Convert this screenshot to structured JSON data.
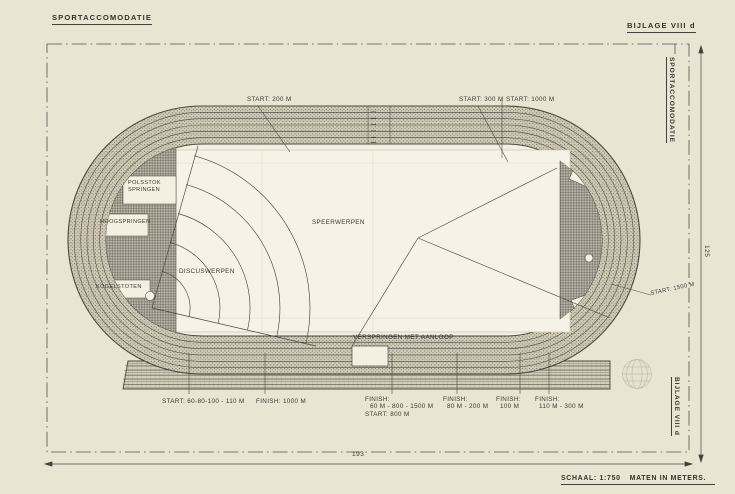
{
  "colors": {
    "paper": "#eae5d3",
    "ink": "#3b372f",
    "infield": "#f3f0e1",
    "field": "#f6f3e6",
    "hatch_gray": "#6b665a"
  },
  "header": {
    "left": "SPORTACCOMODATIE",
    "right": "BIJLAGE VIII d"
  },
  "margin": {
    "side_top": "SPORTACCOMODATIE",
    "side_bottom": "BIJLAGE VIII d",
    "dim_height": "125",
    "dim_width": "193",
    "scale_label": "SCHAAL: 1:750",
    "units_label": "MATEN IN METERS."
  },
  "start_labels": {
    "s200": "START: 200 M",
    "s300": "START: 300 M",
    "s1000": "START: 1000 M",
    "s1500": "START: 1500 M"
  },
  "field_labels": {
    "polsstok_line1": "POLSSTOK",
    "polsstok_line2": "SPRINGEN",
    "hoogspringen": "HOOGSPRINGEN",
    "kogelstoten": "KOGELSTOTEN",
    "speerwerpen": "SPEERWERPEN",
    "discuswerpen": "DISCUSWERPEN",
    "verspringen": "VERSPRINGEN MET AANLOOP"
  },
  "bottom_labels": [
    {
      "lines": [
        "START: 60-80-100 - 110 M"
      ]
    },
    {
      "lines": [
        "FINISH: 1000 M"
      ]
    },
    {
      "lines": [
        "FINISH:",
        "60 M - 800 - 1500 M",
        "START: 800 M"
      ]
    },
    {
      "lines": [
        "FINISH:",
        "80 M - 200 M"
      ]
    },
    {
      "lines": [
        "FINISH:",
        "100 M"
      ]
    },
    {
      "lines": [
        "FINISH:",
        "110 M - 300 M"
      ]
    }
  ]
}
